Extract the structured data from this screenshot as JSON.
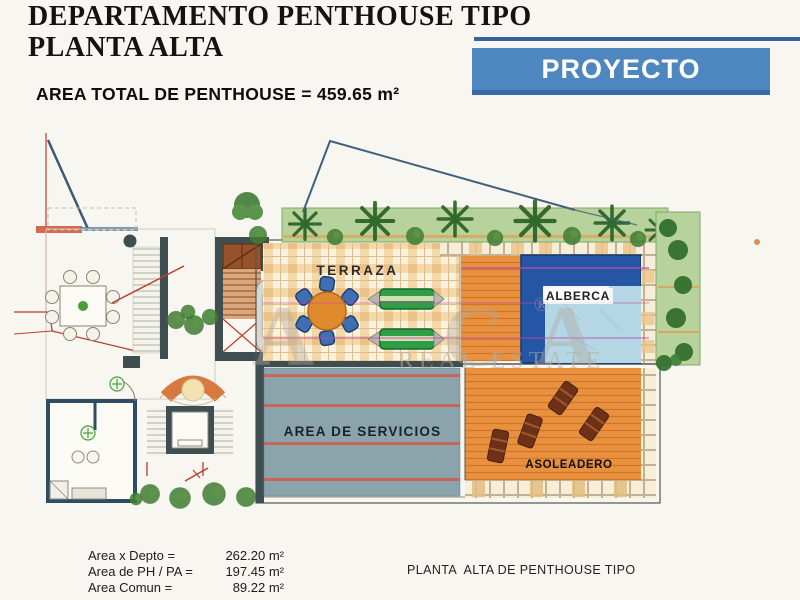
{
  "header": {
    "title_line1": "DEPARTAMENTO PENTHOUSE TIPO",
    "title_line2": "PLANTA ALTA",
    "area_total": "AREA TOTAL DE PENTHOUSE = 459.65 m²"
  },
  "banner": {
    "label": "PROYECTO",
    "bg_color": "#4e86c0",
    "accent_color": "#35639c"
  },
  "plan": {
    "labels": {
      "terraza": "TERRAZA",
      "alberca": "ALBERCA",
      "servicios": "AREA DE SERVICIOS",
      "asoleadero": "ASOLEADERO"
    },
    "colors": {
      "garden": "#b7d29b",
      "tree": "#2e6b2a",
      "terrace_tile": "#f3d8aa",
      "pool_frame": "#2456a5",
      "pool_water": "#b5d6e4",
      "deck_wood": "#e8913f",
      "services_gray": "#8ba4ab",
      "stripe_red": "#cc5f4e",
      "wall_dark": "#3f4f51",
      "section_red": "#c03b2b",
      "dimension_magenta": "#c04ab0"
    }
  },
  "watermark": {
    "big": "A  CA",
    "reg": "®",
    "small": "REAL ESTATE"
  },
  "footer": {
    "areas": [
      {
        "label": "Area x Depto =",
        "value": "262.20 m²"
      },
      {
        "label": "Area de PH / PA =",
        "value": "197.45 m²"
      },
      {
        "label": "Area Comun =",
        "value": "89.22 m²"
      }
    ],
    "caption": "PLANTA  ALTA DE PENTHOUSE TIPO"
  }
}
